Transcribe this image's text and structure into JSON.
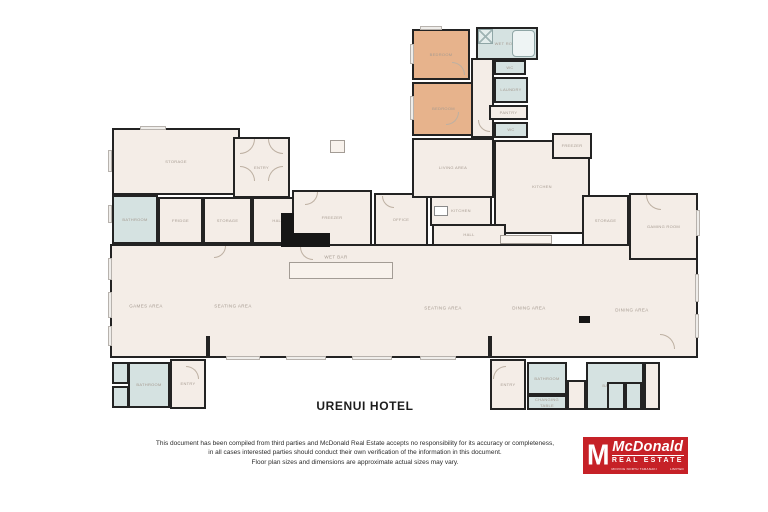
{
  "document": {
    "title": "URENUI HOTEL",
    "disclaimer_lines": [
      "This document has been compiled from third parties and McDonald Real Estate accepts no responsibility for its accuracy or completeness,",
      "in all cases interested parties should conduct their own verification of the information in this document.",
      "Floor plan sizes and dimensions are approximate actual sizes may vary."
    ]
  },
  "logo": {
    "monogram": "M",
    "brand": "McDonald",
    "brand_sub": "REAL ESTATE",
    "tagline_left": "MOVING NORTH TARANAKI",
    "tagline_right": "LIMITED",
    "red": "#c62127"
  },
  "plan": {
    "colors": {
      "wall": "#232323",
      "cream": "#f4ede7",
      "tan": "#e7b38c",
      "blue": "#d5e2e1",
      "label": "#a59a90"
    },
    "rooms": [
      {
        "name": "main-hall",
        "label": "",
        "x": 110,
        "y": 244,
        "w": 588,
        "h": 114,
        "fill": "cream"
      },
      {
        "name": "bedroom-1",
        "label": "BEDROOM",
        "x": 412,
        "y": 29,
        "w": 58,
        "h": 51,
        "fill": "tan"
      },
      {
        "name": "wet-room",
        "label": "WET ROOM",
        "x": 476,
        "y": 27,
        "w": 62,
        "h": 33,
        "fill": "blue"
      },
      {
        "name": "bedroom-2",
        "label": "BEDROOM",
        "x": 412,
        "y": 82,
        "w": 63,
        "h": 54,
        "fill": "tan"
      },
      {
        "name": "top-hall",
        "label": "",
        "x": 471,
        "y": 58,
        "w": 23,
        "h": 80,
        "fill": "cream"
      },
      {
        "name": "wc-north-1",
        "label": "WC",
        "x": 494,
        "y": 60,
        "w": 32,
        "h": 15,
        "fill": "blue"
      },
      {
        "name": "laundry",
        "label": "LAUNDRY",
        "x": 494,
        "y": 77,
        "w": 34,
        "h": 26,
        "fill": "blue"
      },
      {
        "name": "pantry",
        "label": "PANTRY",
        "x": 489,
        "y": 105,
        "w": 39,
        "h": 15,
        "fill": "cream"
      },
      {
        "name": "wc-north-2",
        "label": "WC",
        "x": 494,
        "y": 122,
        "w": 34,
        "h": 16,
        "fill": "blue"
      },
      {
        "name": "storage-main",
        "label": "STORAGE",
        "x": 112,
        "y": 128,
        "w": 128,
        "h": 67,
        "fill": "cream"
      },
      {
        "name": "entry-main",
        "label": "ENTRY",
        "x": 233,
        "y": 137,
        "w": 57,
        "h": 61,
        "fill": "cream"
      },
      {
        "name": "bathroom-west",
        "label": "BATHROOM",
        "x": 112,
        "y": 195,
        "w": 46,
        "h": 49,
        "fill": "blue"
      },
      {
        "name": "fridge-room",
        "label": "FRIDGE",
        "x": 158,
        "y": 197,
        "w": 45,
        "h": 47,
        "fill": "cream"
      },
      {
        "name": "storage-2",
        "label": "STORAGE",
        "x": 203,
        "y": 197,
        "w": 49,
        "h": 47,
        "fill": "cream"
      },
      {
        "name": "hall-west",
        "label": "HALL",
        "x": 252,
        "y": 197,
        "w": 52,
        "h": 47,
        "fill": "cream"
      },
      {
        "name": "freezer-1",
        "label": "FREEZER",
        "x": 292,
        "y": 190,
        "w": 80,
        "h": 56,
        "fill": "cream"
      },
      {
        "name": "office",
        "label": "OFFICE",
        "x": 374,
        "y": 193,
        "w": 54,
        "h": 53,
        "fill": "cream"
      },
      {
        "name": "living-area",
        "label": "LIVING AREA",
        "x": 412,
        "y": 138,
        "w": 82,
        "h": 60,
        "fill": "cream"
      },
      {
        "name": "kitchen-nook",
        "label": "KITCHEN",
        "x": 430,
        "y": 196,
        "w": 62,
        "h": 30,
        "fill": "cream"
      },
      {
        "name": "kitchen-main",
        "label": "KITCHEN",
        "x": 494,
        "y": 140,
        "w": 96,
        "h": 94,
        "fill": "cream"
      },
      {
        "name": "hall-mid",
        "label": "HALL",
        "x": 432,
        "y": 224,
        "w": 74,
        "h": 22,
        "fill": "cream"
      },
      {
        "name": "freezer-2",
        "label": "FREEZER",
        "x": 552,
        "y": 133,
        "w": 40,
        "h": 26,
        "fill": "cream"
      },
      {
        "name": "storage-east",
        "label": "STORAGE",
        "x": 582,
        "y": 195,
        "w": 47,
        "h": 51,
        "fill": "cream"
      },
      {
        "name": "gaming-room",
        "label": "GAMING ROOM",
        "x": 629,
        "y": 193,
        "w": 69,
        "h": 67,
        "fill": "cream"
      },
      {
        "name": "entry-sw",
        "label": "ENTRY",
        "x": 170,
        "y": 359,
        "w": 36,
        "h": 50,
        "fill": "cream"
      },
      {
        "name": "bathroom-sw",
        "label": "BATHROOM",
        "x": 128,
        "y": 362,
        "w": 42,
        "h": 46,
        "fill": "blue"
      },
      {
        "name": "shower-sw",
        "label": "",
        "x": 112,
        "y": 362,
        "w": 17,
        "h": 22,
        "fill": "blue"
      },
      {
        "name": "wc-sw",
        "label": "",
        "x": 112,
        "y": 386,
        "w": 17,
        "h": 22,
        "fill": "blue"
      },
      {
        "name": "entry-se",
        "label": "ENTRY",
        "x": 490,
        "y": 359,
        "w": 36,
        "h": 51,
        "fill": "cream"
      },
      {
        "name": "bathroom-se-1",
        "label": "BATHROOM",
        "x": 527,
        "y": 362,
        "w": 40,
        "h": 33,
        "fill": "blue"
      },
      {
        "name": "changing-area",
        "label": "CHANGING TABLE",
        "x": 527,
        "y": 395,
        "w": 40,
        "h": 15,
        "fill": "blue"
      },
      {
        "name": "corridor-se",
        "label": "",
        "x": 567,
        "y": 380,
        "w": 19,
        "h": 30,
        "fill": "cream"
      },
      {
        "name": "bathroom-se-2",
        "label": "BATHROOM",
        "x": 586,
        "y": 362,
        "w": 58,
        "h": 48,
        "fill": "blue"
      },
      {
        "name": "wc-stall-1",
        "label": "",
        "x": 607,
        "y": 382,
        "w": 18,
        "h": 28,
        "fill": "blue"
      },
      {
        "name": "wc-stall-2",
        "label": "",
        "x": 625,
        "y": 382,
        "w": 17,
        "h": 28,
        "fill": "blue"
      },
      {
        "name": "vestibule-se",
        "label": "",
        "x": 644,
        "y": 362,
        "w": 16,
        "h": 48,
        "fill": "cream"
      }
    ],
    "area_labels": [
      {
        "label": "GAMES AREA",
        "x": 146,
        "y": 306
      },
      {
        "label": "SEATING AREA",
        "x": 233,
        "y": 306
      },
      {
        "label": "WET BAR",
        "x": 336,
        "y": 257
      },
      {
        "label": "SEATING AREA",
        "x": 443,
        "y": 308
      },
      {
        "label": "DINING AREA",
        "x": 529,
        "y": 308
      },
      {
        "label": "DINING AREA",
        "x": 632,
        "y": 310
      }
    ],
    "windows": [
      {
        "x": 108,
        "y": 150,
        "w": 4,
        "h": 22
      },
      {
        "x": 108,
        "y": 205,
        "w": 4,
        "h": 18
      },
      {
        "x": 108,
        "y": 258,
        "w": 4,
        "h": 22
      },
      {
        "x": 108,
        "y": 292,
        "w": 4,
        "h": 26
      },
      {
        "x": 108,
        "y": 326,
        "w": 4,
        "h": 20
      },
      {
        "x": 140,
        "y": 126,
        "w": 26,
        "h": 4
      },
      {
        "x": 226,
        "y": 356,
        "w": 34,
        "h": 4
      },
      {
        "x": 286,
        "y": 356,
        "w": 40,
        "h": 4
      },
      {
        "x": 352,
        "y": 356,
        "w": 40,
        "h": 4
      },
      {
        "x": 420,
        "y": 356,
        "w": 36,
        "h": 4
      },
      {
        "x": 695,
        "y": 274,
        "w": 4,
        "h": 28
      },
      {
        "x": 695,
        "y": 314,
        "w": 4,
        "h": 24
      },
      {
        "x": 420,
        "y": 26,
        "w": 22,
        "h": 4
      },
      {
        "x": 410,
        "y": 44,
        "w": 4,
        "h": 20
      },
      {
        "x": 410,
        "y": 96,
        "w": 4,
        "h": 24
      },
      {
        "x": 696,
        "y": 210,
        "w": 4,
        "h": 26
      }
    ],
    "doors": [
      {
        "x": 240,
        "y": 139,
        "r": 15,
        "q": "br"
      },
      {
        "x": 268,
        "y": 139,
        "r": 15,
        "q": "bl"
      },
      {
        "x": 240,
        "y": 166,
        "r": 15,
        "q": "tr"
      },
      {
        "x": 268,
        "y": 166,
        "r": 15,
        "q": "tl"
      },
      {
        "x": 452,
        "y": 62,
        "r": 13,
        "q": "tr"
      },
      {
        "x": 446,
        "y": 112,
        "r": 13,
        "q": "br"
      },
      {
        "x": 478,
        "y": 120,
        "r": 12,
        "q": "bl"
      },
      {
        "x": 646,
        "y": 195,
        "r": 15,
        "q": "bl"
      },
      {
        "x": 186,
        "y": 366,
        "r": 13,
        "q": "tr"
      },
      {
        "x": 493,
        "y": 366,
        "r": 13,
        "q": "tl"
      },
      {
        "x": 660,
        "y": 334,
        "r": 15,
        "q": "tr"
      },
      {
        "x": 305,
        "y": 192,
        "r": 13,
        "q": "br"
      },
      {
        "x": 382,
        "y": 196,
        "r": 12,
        "q": "bl"
      },
      {
        "x": 300,
        "y": 247,
        "r": 13,
        "q": "bl"
      },
      {
        "x": 214,
        "y": 246,
        "r": 12,
        "q": "br"
      }
    ],
    "fixtures": [
      {
        "kind": "black",
        "name": "stairs",
        "x": 281,
        "y": 213,
        "w": 13,
        "h": 28
      },
      {
        "kind": "black",
        "name": "stairs",
        "x": 281,
        "y": 233,
        "w": 49,
        "h": 14
      },
      {
        "kind": "black",
        "name": "column",
        "x": 579,
        "y": 316,
        "w": 11,
        "h": 7
      },
      {
        "kind": "outline",
        "name": "wet-bar-counter",
        "x": 289,
        "y": 262,
        "w": 104,
        "h": 17
      },
      {
        "kind": "outline",
        "name": "kitchen-counter",
        "x": 500,
        "y": 235,
        "w": 52,
        "h": 9
      },
      {
        "kind": "outline",
        "name": "wall-cabinet",
        "x": 330,
        "y": 140,
        "w": 15,
        "h": 13
      },
      {
        "kind": "bath",
        "name": "bathtub",
        "x": 512,
        "y": 30,
        "w": 23,
        "h": 27
      },
      {
        "kind": "shower",
        "name": "shower",
        "x": 478,
        "y": 29,
        "w": 15,
        "h": 15
      },
      {
        "kind": "stove",
        "name": "stove",
        "x": 434,
        "y": 206,
        "w": 14,
        "h": 10
      },
      {
        "kind": "wall",
        "name": "wall-stub",
        "x": 206,
        "y": 336,
        "w": 4,
        "h": 22
      },
      {
        "kind": "wall",
        "name": "wall-stub",
        "x": 488,
        "y": 336,
        "w": 4,
        "h": 22
      }
    ]
  }
}
